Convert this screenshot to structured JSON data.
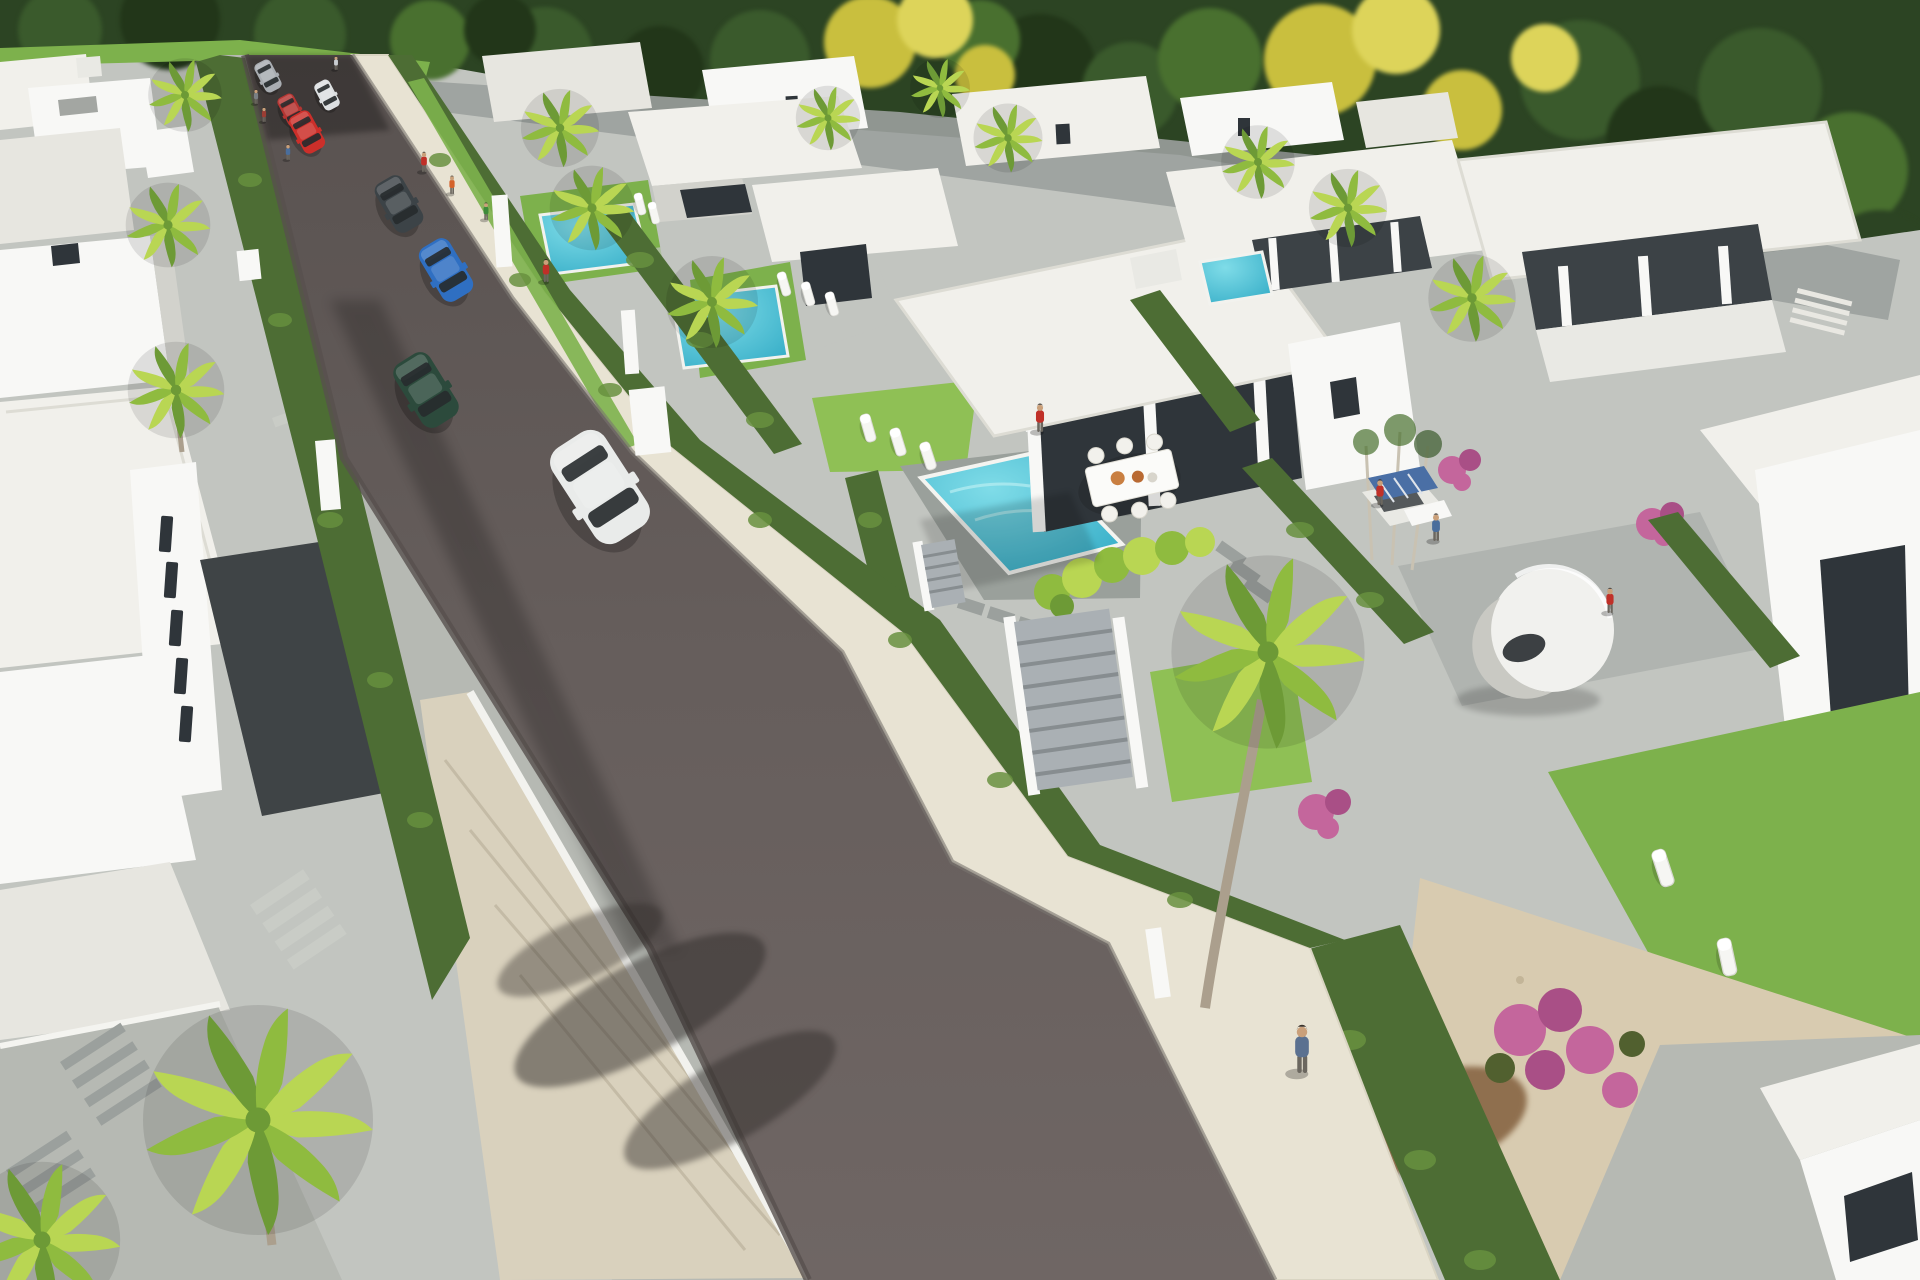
{
  "scene": {
    "type": "architectural-3d-render",
    "description": "Aerial perspective rendering of a modern residential villa development: a dark asphalt street runs diagonally from top-left to bottom-center, lined with hedges and cream sidewalks; white flat-roofed villas with turquoise pools, palm trees and landscaped gardens on both sides; dense forest with yellow flowering trees at the top",
    "camera": "high aerial, looking down the street toward bottom-right",
    "lighting": "midday sun from upper right, shadows fall to lower left",
    "palette": {
      "forest1": "#2c4423",
      "forest2": "#3a5a2c",
      "forest3": "#49702f",
      "forest4": "#223619",
      "yellow1": "#c9bf3e",
      "yellow2": "#ddd45a",
      "white": "#f8f8f6",
      "whiteDim": "#e9e9e4",
      "roof": "#f1f0eb",
      "roof2": "#e7e6e0",
      "wallShadow": "#d2d2cc",
      "glass": "#2f353a",
      "glass2": "#3c4246",
      "roadTop": "#595250",
      "roadMid": "#665e5c",
      "roadLow": "#6f6664",
      "curb": "#8b8b86",
      "sideCream": "#e8e3d3",
      "sideGray": "#b6b9b3",
      "pave": "#c2c5c0",
      "paveDark": "#9ba09d",
      "charcoal": "#3f4446",
      "stone": "#d9d1bd",
      "hedge": "#4d6d34",
      "hedge2": "#68913f",
      "lawn": "#7db14c",
      "lawn2": "#8fc055",
      "palm1": "#b9d653",
      "palm2": "#8fbb3f",
      "palm3": "#6d9a36",
      "pool1": "#7fdce8",
      "pool2": "#2fa9c4",
      "deck": "#9aa09b",
      "gravel": "#d8cbb0",
      "dirt": "#8f6f4e",
      "pink": "#c4669c",
      "pink2": "#a94f86",
      "gate": "#aab0b4",
      "gateLine": "#878d90",
      "trunk": "#ab9f8d",
      "solar": "#4a6fa5"
    },
    "street": {
      "surface": "dark asphalt",
      "orientation": "diagonal, vanishing at top-left under trees, widening toward viewer at bottom",
      "left_sidewalk": "gray pavers with stone retaining wall near bottom",
      "right_sidewalk": "cream stone pavers with white perimeter walls, hedges and gray slatted gates",
      "cars": [
        {
          "name": "car-silver-hatchback",
          "color": "#a9adb2",
          "x": 268,
          "y": 76,
          "s": 0.32,
          "r": -28
        },
        {
          "name": "car-white-compact",
          "color": "#dde0e2",
          "x": 327,
          "y": 95,
          "s": 0.3,
          "r": -28
        },
        {
          "name": "car-red-sedan",
          "color": "#b53532",
          "x": 291,
          "y": 110,
          "s": 0.32,
          "r": -28
        },
        {
          "name": "car-red-suv",
          "color": "#cc2f2a",
          "x": 307,
          "y": 132,
          "s": 0.42,
          "r": -29
        },
        {
          "name": "car-charcoal-sedan",
          "color": "#3c4347",
          "x": 399,
          "y": 204,
          "s": 0.56,
          "r": -30
        },
        {
          "name": "car-blue-hatchback",
          "color": "#2f6fc2",
          "x": 446,
          "y": 270,
          "s": 0.62,
          "r": -31
        },
        {
          "name": "car-green-coupe",
          "color": "#2c4a3c",
          "x": 426,
          "y": 390,
          "s": 0.74,
          "r": -32
        },
        {
          "name": "car-white-suv",
          "color": "#e9ebea",
          "x": 600,
          "y": 487,
          "s": 1.12,
          "r": -33
        }
      ]
    },
    "people": [
      {
        "name": "pedestrian-red-shirt",
        "color": "#c03028",
        "x": 424,
        "y": 172,
        "s": 0.44
      },
      {
        "name": "pedestrian-orange-shirt",
        "color": "#d4622a",
        "x": 452,
        "y": 194,
        "s": 0.4
      },
      {
        "name": "pedestrian-green-shirt",
        "color": "#3d8a3a",
        "x": 486,
        "y": 220,
        "s": 0.38
      },
      {
        "name": "pedestrian-red-walking",
        "color": "#c03028",
        "x": 546,
        "y": 282,
        "s": 0.5
      },
      {
        "name": "pedestrian-gray",
        "color": "#7a7f84",
        "x": 256,
        "y": 104,
        "s": 0.32
      },
      {
        "name": "pedestrian-maroon",
        "color": "#9a3d34",
        "x": 264,
        "y": 122,
        "s": 0.32
      },
      {
        "name": "pedestrian-blue",
        "color": "#4a6e9c",
        "x": 288,
        "y": 160,
        "s": 0.34
      },
      {
        "name": "pedestrian-white-far",
        "color": "#c9cdd1",
        "x": 336,
        "y": 70,
        "s": 0.3
      },
      {
        "name": "woman-red-swimsuit-pool",
        "color": "#c03028",
        "x": 1040,
        "y": 432,
        "s": 0.62
      },
      {
        "name": "worker-red-shirt-solarbox",
        "color": "#c03028",
        "x": 1380,
        "y": 505,
        "s": 0.56
      },
      {
        "name": "worker-blue-shirt-solarbox",
        "color": "#4a6e9c",
        "x": 1436,
        "y": 541,
        "s": 0.6
      },
      {
        "name": "woman-red-near-pod",
        "color": "#c03028",
        "x": 1610,
        "y": 613,
        "s": 0.55
      },
      {
        "name": "man-blue-jacket-sidewalk",
        "color": "#5b7190",
        "x": 1302,
        "y": 1073,
        "s": 1.05
      }
    ],
    "vegetation": {
      "palms": [
        {
          "name": "palm-left-row-1",
          "x": 185,
          "y": 95,
          "s": 0.8
        },
        {
          "name": "palm-left-row-2",
          "x": 168,
          "y": 225,
          "s": 0.92
        },
        {
          "name": "palm-left-row-3",
          "x": 176,
          "y": 390,
          "s": 1.05
        },
        {
          "name": "palm-villa-r1-a",
          "x": 560,
          "y": 128,
          "s": 0.85
        },
        {
          "name": "palm-villa-r1-b",
          "x": 592,
          "y": 208,
          "s": 0.92
        },
        {
          "name": "palm-over-rear-pool",
          "x": 712,
          "y": 302,
          "s": 1.0
        },
        {
          "name": "palm-background-1",
          "x": 828,
          "y": 118,
          "s": 0.7
        },
        {
          "name": "palm-background-2",
          "x": 940,
          "y": 88,
          "s": 0.65
        },
        {
          "name": "palm-background-3",
          "x": 1008,
          "y": 138,
          "s": 0.75
        },
        {
          "name": "palm-background-4",
          "x": 1258,
          "y": 162,
          "s": 0.8
        },
        {
          "name": "palm-background-5",
          "x": 1348,
          "y": 208,
          "s": 0.85
        },
        {
          "name": "palm-villa-r4",
          "x": 1472,
          "y": 298,
          "s": 0.95
        },
        {
          "name": "palm-right-garden-large",
          "x": 1268,
          "y": 652,
          "s": 2.1
        },
        {
          "name": "palm-bottom-left-large",
          "x": 258,
          "y": 1120,
          "s": 2.5
        },
        {
          "name": "palm-bottom-left-small",
          "x": 42,
          "y": 1240,
          "s": 1.7
        }
      ],
      "other": [
        "dense forest backdrop",
        "yellow flowering trees",
        "boxwood hedges",
        "bright shrub row",
        "pink bougainvillea clusters",
        "grass verges"
      ]
    },
    "furniture": {
      "loungers": [
        {
          "name": "lounger-r1-a",
          "x": 640,
          "y": 204,
          "s": 0.5,
          "r": -14
        },
        {
          "name": "lounger-r1-b",
          "x": 654,
          "y": 213,
          "s": 0.5,
          "r": -14
        },
        {
          "name": "lounger-rear-a",
          "x": 784,
          "y": 284,
          "s": 0.55,
          "r": -16
        },
        {
          "name": "lounger-rear-b",
          "x": 808,
          "y": 294,
          "s": 0.55,
          "r": -16
        },
        {
          "name": "lounger-rear-c",
          "x": 832,
          "y": 304,
          "s": 0.55,
          "r": -16
        },
        {
          "name": "lounger-hero-a",
          "x": 868,
          "y": 428,
          "s": 0.64,
          "r": -16
        },
        {
          "name": "lounger-hero-b",
          "x": 898,
          "y": 442,
          "s": 0.64,
          "r": -17
        },
        {
          "name": "lounger-hero-c",
          "x": 928,
          "y": 456,
          "s": 0.64,
          "r": -18
        },
        {
          "name": "lounger-bottom-lawn-a",
          "x": 1663,
          "y": 868,
          "s": 0.85,
          "r": -18
        },
        {
          "name": "lounger-bottom-lawn-b",
          "x": 1727,
          "y": 957,
          "s": 0.85,
          "r": -12
        }
      ],
      "dining_set": {
        "location": "hero villa terrace",
        "chairs": 6,
        "plates": "orange bowls"
      },
      "pod_sculpture": "white spherical sun pod in right garden",
      "solar_box": "white crate with blue solar panels being assembled by two workers"
    },
    "pools": [
      {
        "name": "pool-hero-villa",
        "water": "turquoise"
      },
      {
        "name": "pool-villa-r1",
        "water": "turquoise"
      },
      {
        "name": "pool-rear-villa",
        "water": "turquoise"
      },
      {
        "name": "pool-villa-r3",
        "water": "turquoise"
      }
    ],
    "buildings": {
      "style": "modern white cubic villas, flat roofs, dark glass walls",
      "left_side": [
        "row of white roofs at top-left",
        "large textured roof",
        "tall white block with five slit windows",
        "charcoal driveway",
        "bottom terraces with paver stripes"
      ],
      "right_side": [
        "villa R1 with pool and loungers",
        "rear villa with palm pool",
        "hero villa with pool, dining set and woman in red",
        "villa R3 with dark terrace",
        "large villa R4 with columned terrace and steps",
        "far-right villa corner",
        "bottom-right villa corner"
      ]
    }
  }
}
